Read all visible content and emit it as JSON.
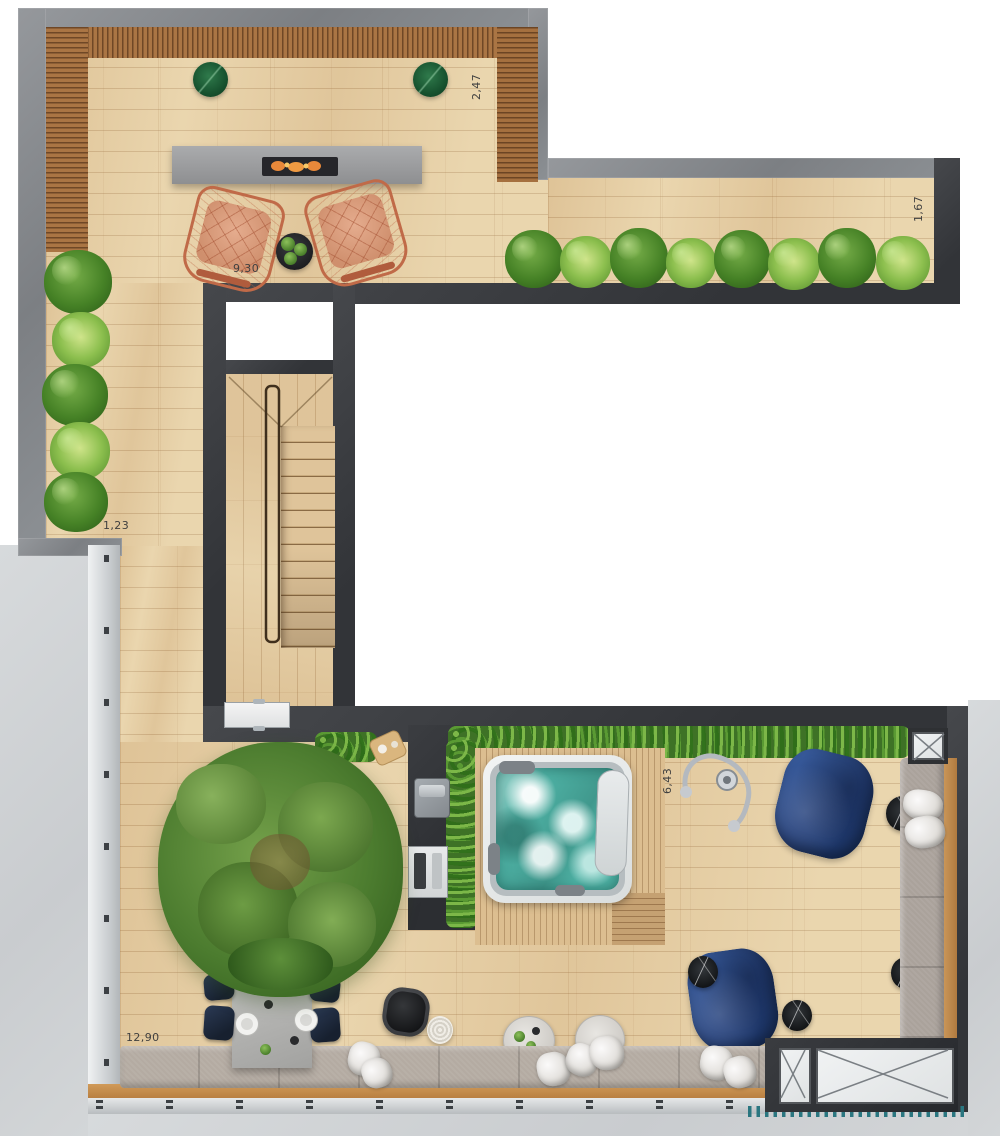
{
  "dimension_labels": {
    "upper_terrace_width": "9,30",
    "upper_right_depth": "2,47",
    "left_passage_width": "1,23",
    "wing_depth": "1,67",
    "lower_terrace_depth": "6,43",
    "lower_terrace_width": "12,90"
  },
  "palette": {
    "wood_floor": "#e7d2aa",
    "wood_slat_bench": "#aa7544",
    "wall_light_gray": "#85888c",
    "wall_dark": "#3a3c3f",
    "hedge_green": "#3e7226",
    "plant_green": "#6aa84f",
    "jacuzzi_water_teal": "#4fb3a6",
    "beanbag_blue": "#24407c",
    "chair_terracotta": "#dca084",
    "concrete_gray": "#9a9b9d",
    "cushion_taupe": "#b4aba2",
    "dotted_edge_teal": "#2a7680"
  }
}
